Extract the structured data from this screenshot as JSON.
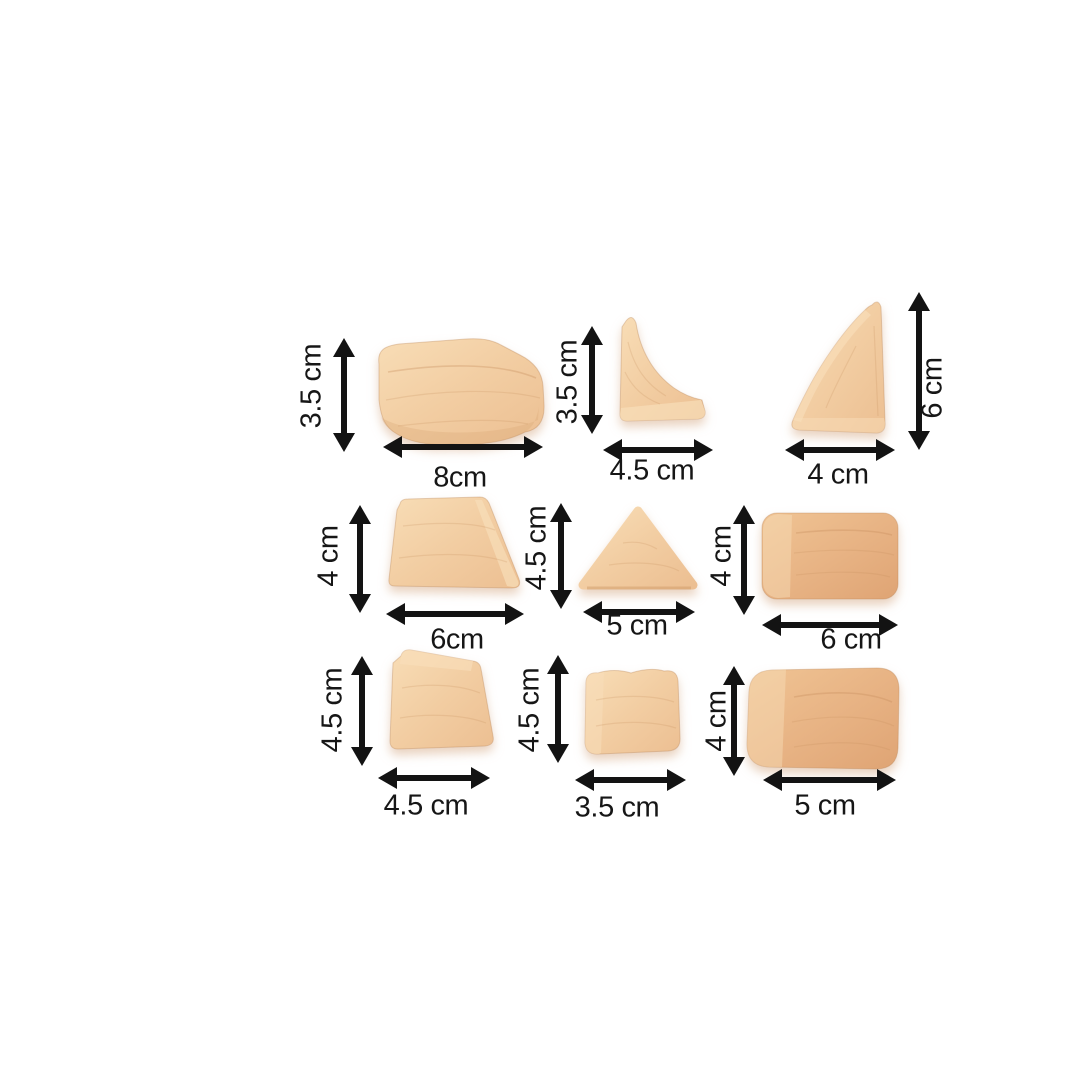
{
  "page": {
    "background": "#ffffff"
  },
  "colors": {
    "arrow": "#131313",
    "label_text": "#161616",
    "wood_light": "#f2cda2",
    "wood_dark": "#e7b283"
  },
  "blocks": [
    {
      "name": "curved-bar-block",
      "height": "3.5 cm",
      "width": "8cm"
    },
    {
      "name": "small-cove-corner-block",
      "height": "3.5 cm",
      "width": "4.5 cm"
    },
    {
      "name": "large-cove-corner-block",
      "height": "6 cm",
      "width": "4 cm"
    },
    {
      "name": "trapezoid-block",
      "height": "4 cm",
      "width": "6cm"
    },
    {
      "name": "triangle-block",
      "height": "4.5 cm",
      "width": "5 cm"
    },
    {
      "name": "rounded-rectangle-block-6cm",
      "height": "4 cm",
      "width": "6 cm"
    },
    {
      "name": "wedge-block",
      "height": "4.5 cm",
      "width": "4.5 cm"
    },
    {
      "name": "cushion-block",
      "height": "4.5 cm",
      "width": "3.5 cm"
    },
    {
      "name": "rounded-rectangle-block-5cm",
      "height": "4 cm",
      "width": "5 cm"
    }
  ]
}
